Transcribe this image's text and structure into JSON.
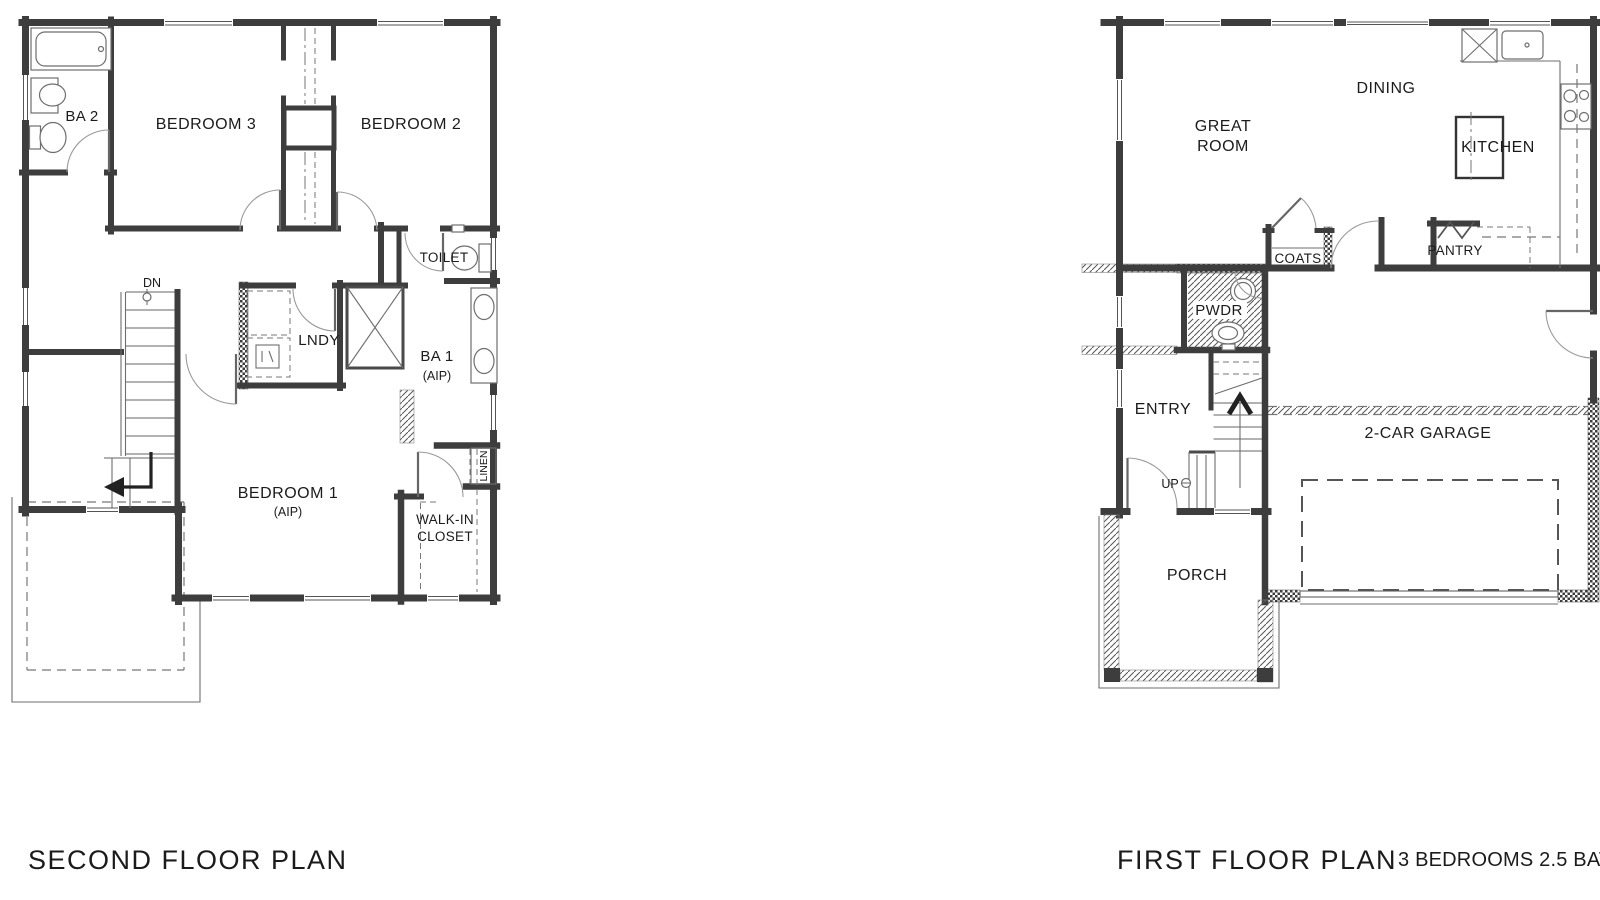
{
  "drawing": {
    "second_floor": {
      "title": "SECOND FLOOR PLAN",
      "rooms": {
        "ba2": "BA 2",
        "bedroom3": "BEDROOM 3",
        "bedroom2": "BEDROOM 2",
        "toilet": "TOILET",
        "stairs_dn": "DN",
        "laundry": "LNDY",
        "ba1": "BA 1",
        "ba1_note": "(AIP)",
        "bedroom1": "BEDROOM 1",
        "bedroom1_note": "(AIP)",
        "linen": "LINEN",
        "walkin_line1": "WALK-IN",
        "walkin_line2": "CLOSET"
      }
    },
    "first_floor": {
      "title": "FIRST FLOOR PLAN",
      "rooms": {
        "great_line1": "GREAT",
        "great_line2": "ROOM",
        "dining": "DINING",
        "kitchen": "KITCHEN",
        "coats": "COATS",
        "pantry": "PANTRY",
        "pwdr": "PWDR",
        "entry": "ENTRY",
        "stairs_up": "UP",
        "garage": "2-CAR GARAGE",
        "porch": "PORCH"
      }
    },
    "summary": "3 BEDROOMS 2.5 BATHS",
    "colors": {
      "wall": "#3d3d3d",
      "line": "#6e6e6e",
      "text": "#1b1b1b",
      "background": "#ffffff"
    }
  }
}
